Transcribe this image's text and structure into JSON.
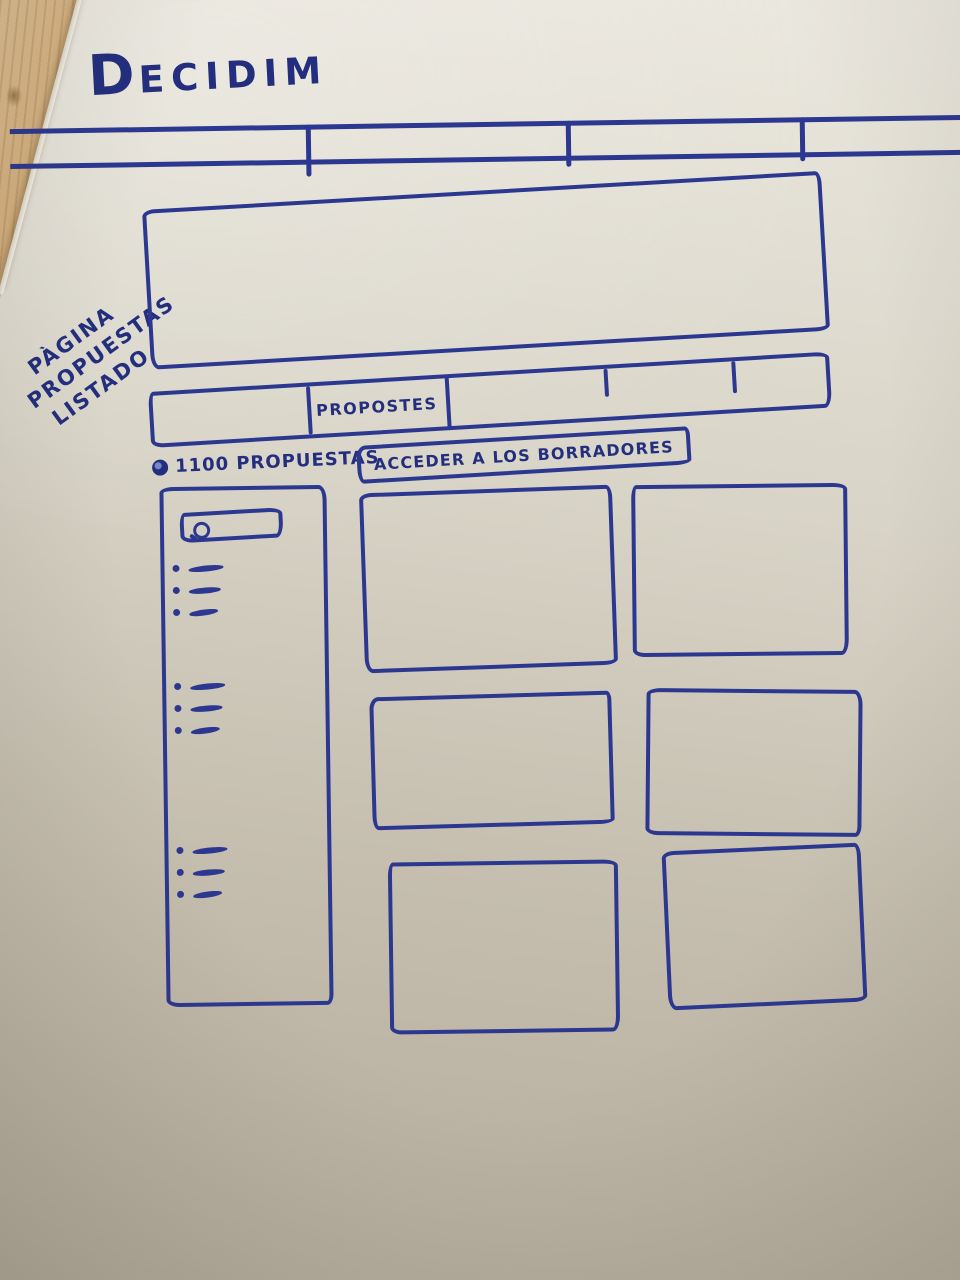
{
  "colors": {
    "ink": "#2c3890",
    "ink_dark": "#232e7e",
    "paper_top": "#ebe8df",
    "paper_mid": "#d8d4c7",
    "paper_bottom": "#b3ab9b",
    "wood_light": "#dcbd91",
    "wood_dark": "#c09a67"
  },
  "logo": {
    "text": "DECIDIM"
  },
  "side_annotation": {
    "lines": [
      "PÀGINA",
      "PROPUESTAS",
      "LISTADO"
    ]
  },
  "navbar": {
    "item_count": 4
  },
  "tabs": {
    "items": [
      "",
      "PROPOSTES",
      "",
      "",
      ""
    ]
  },
  "proposals_header": {
    "count_label": "1100 PROPUESTAS",
    "drafts_button_label": "ACCEDER A LOS BORRADORES"
  },
  "sidebar": {
    "search_placeholder": "",
    "filter_groups": [
      {
        "item_count": 3
      },
      {
        "item_count": 3
      },
      {
        "item_count": 3
      }
    ]
  },
  "cards": {
    "count": 6
  },
  "icons": {
    "search": "magnifier-circle-with-handle",
    "count_marker": "filled-circle"
  }
}
